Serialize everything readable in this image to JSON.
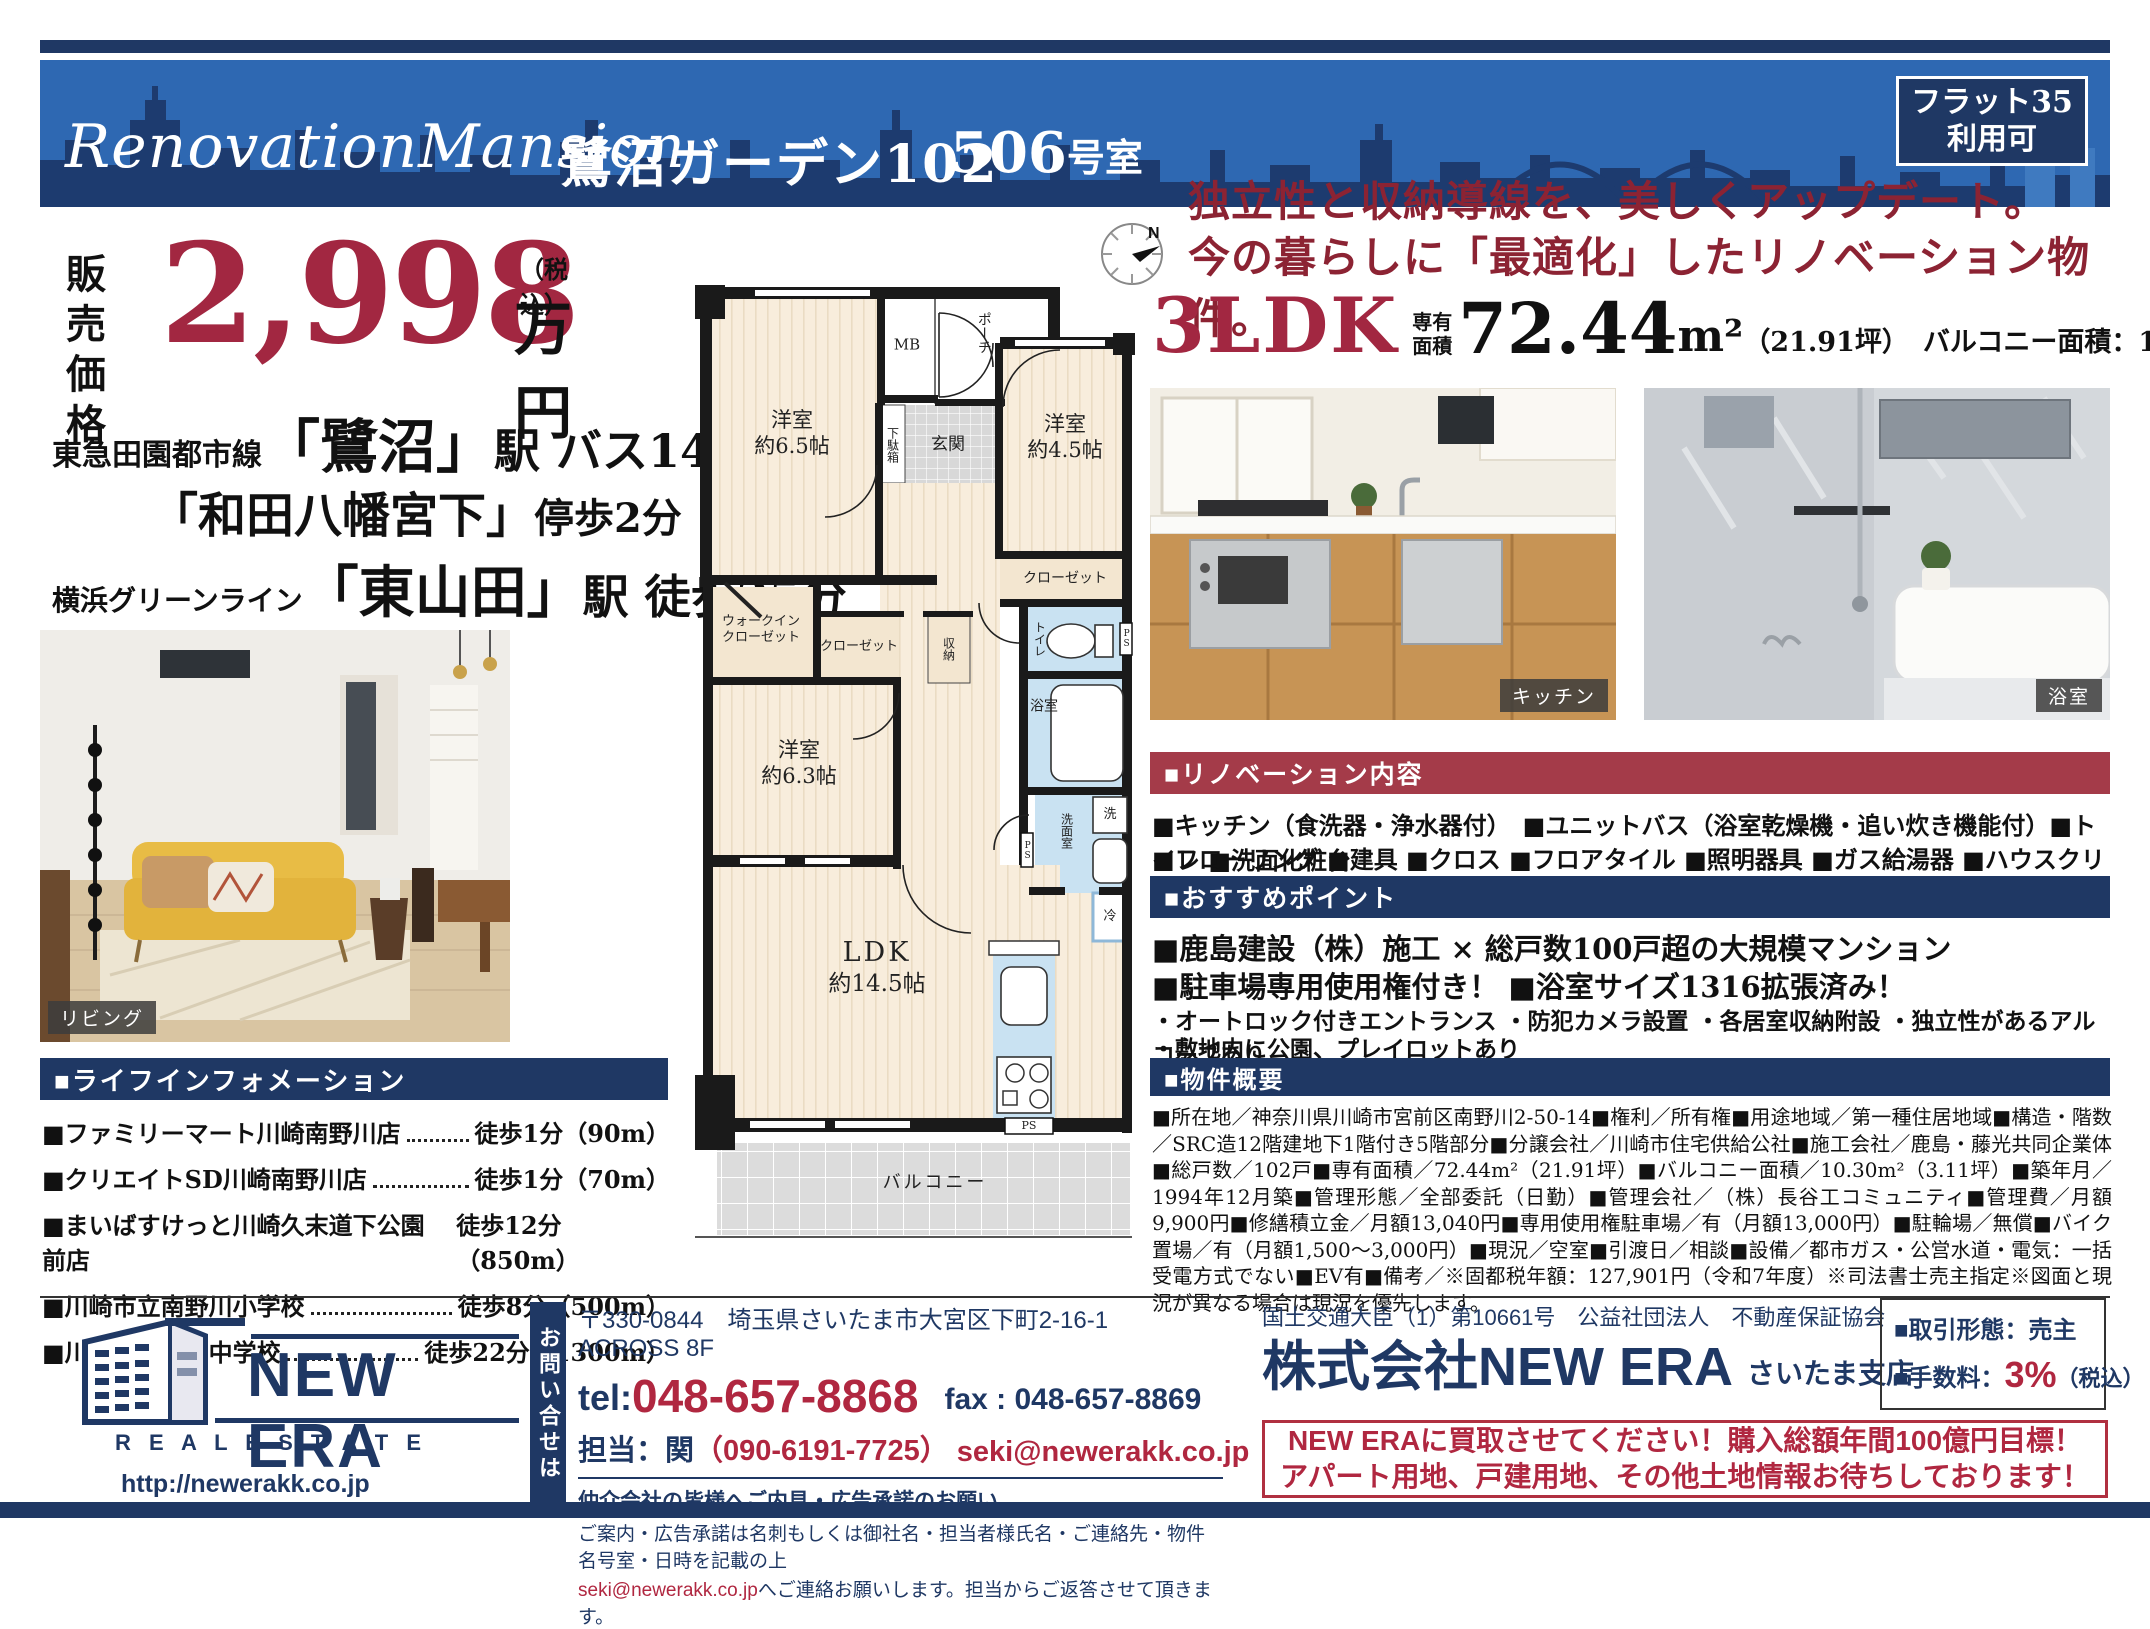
{
  "banner": {
    "title_en": "RenovationMansion",
    "title_name": "鷺沼ガーデン102",
    "room_num": "506",
    "room_suffix": "号室",
    "badge_line1": "フラット35",
    "badge_line2": "利用可"
  },
  "price": {
    "label1": "販売",
    "label2": "価格",
    "amount": "2,998",
    "tax": "（税込）",
    "unit": "万円"
  },
  "access": {
    "line1_prefix": "東急田園都市線",
    "line1_station": "「鷺沼」",
    "line1_rest": "駅 バス14分",
    "line2_station": "「和田八幡宮下」",
    "line2_rest": "停歩2分",
    "line3_prefix": "横浜グリーンライン",
    "line3_station": "「東山田」",
    "line3_rest": "駅 徒歩25分"
  },
  "living": {
    "label": "リビング"
  },
  "life_info": {
    "header": "■ライフインフォメーション",
    "items": [
      {
        "name": "■ファミリーマート川崎南野川店",
        "value": "徒歩1分（90m）"
      },
      {
        "name": "■クリエイトSD川崎南野川店",
        "value": "徒歩1分（70m）"
      },
      {
        "name": "■まいばすけっと川崎久末道下公園前店",
        "value": "徒歩12分（850m）"
      },
      {
        "name": "■川崎市立南野川小学校",
        "value": "徒歩8分（500m）"
      },
      {
        "name": "■川崎市立野川中学校",
        "value": "徒歩22分（1300m）"
      }
    ]
  },
  "plan": {
    "compass": "N",
    "rooms": {
      "mb": "MB",
      "porch": "ポーチ",
      "genkan": "玄関",
      "getabako": "下駄箱",
      "west65_name": "洋室",
      "west65_size": "約6.5帖",
      "west45_name": "洋室",
      "west45_size": "約4.5帖",
      "closet45": "クローゼット",
      "wic1": "ウォークイン",
      "wic2": "クローゼット",
      "closet_small": "クローゼット",
      "shuno": "収納",
      "toilet": "トイレ",
      "ps1": "PS",
      "bath": "浴室",
      "senmen": "洗面室",
      "washer": "洗",
      "ps2": "PS",
      "west63_name": "洋室",
      "west63_size": "約6.3帖",
      "ldk_name": "LDK",
      "ldk_size": "約14.5帖",
      "fridge": "冷",
      "ps3": "PS",
      "balcony": "バルコニー"
    }
  },
  "main": {
    "catch1": "独立性と収納導線を、美しくアップデート。",
    "catch2": "今の暮らしに「最適化」したリノベーション物件。",
    "layout": "3LDK",
    "area_label1": "専有",
    "area_label2": "面積",
    "area_value": "72.44",
    "area_unit": "m²",
    "area_tsubo": "（21.91坪）",
    "balcony_area": "バルコニー面積：10.30m²"
  },
  "photos": {
    "kitchen": "キッチン",
    "bath": "浴室"
  },
  "renovation": {
    "header": "■リノベーション内容",
    "line1": "■キッチン（食洗器・浄水器付）　■ユニットバス（浴室乾燥機・追い炊き機能付）■トイレ ■洗面化粧台",
    "line2": "■フローリング ■建具 ■クロス ■フロアタイル ■照明器具 ■ガス給湯器 ■ハウスクリーニング"
  },
  "points": {
    "header": "■おすすめポイント",
    "bold1": "■鹿島建設（株）施工 × 総戸数100戸超の大規模マンション",
    "bold2": "■駐車場専用使用権付き！ ■浴室サイズ1316拡張済み！",
    "sub1": "・オートロック付きエントランス ・防犯カメラ設置 ・各居室収納附設 ・独立性があるアルコーブあり",
    "sub2": "・敷地内に公園、プレイロットあり"
  },
  "overview": {
    "header": "■物件概要",
    "text": "■所在地／神奈川県川崎市宮前区南野川2-50-14■権利／所有権■用途地域／第一種住居地域■構造・階数／SRC造12階建地下1階付き5階部分■分譲会社／川崎市住宅供給公社■施工会社／鹿島・藤光共同企業体■総戸数／102戸■専有面積／72.44m²（21.91坪）■バルコニー面積／10.30m²（3.11坪）■築年月／1994年12月築■管理形態／全部委託（日勤）■管理会社／（株）長谷工コミュニティ■管理費／月額9,900円■修繕積立金／月額13,040円■専用使用権駐車場／有（月額13,000円）■駐輪場／無償■バイク置場／有（月額1,500～3,000円）■現況／空室■引渡日／相談■設備／都市ガス・公営水道・電気：一括受電方式でない■EV有■備考／※固都税年額：127,901円（令和7年度）※司法書士売主指定※図面と現況が異なる場合は現況を優先します。"
  },
  "footer": {
    "inquiry_vertical": "お問い合せは",
    "logo_name": "NEW ERA",
    "logo_sub": "R E A L   E S T A T E",
    "url": "http://newerakk.co.jp",
    "address": "〒330-0844　埼玉県さいたま市大宮区下町2-16-1　ACROSS 8F",
    "tel_label": "tel:",
    "tel_number": "048-657-8868",
    "fax": "fax : 048-657-8869",
    "staff_label": "担当：関",
    "staff_phone": "（090-6191-7725）",
    "staff_email": "seki@newerakk.co.jp",
    "notice_title": "仲介会社の皆様へご内見・広告承諾のお願い",
    "notice_line1": "ご案内・広告承諾は名刺もしくは御社名・担当者様氏名・ご連絡先・物件名号室・日時を記載の上",
    "notice_line2_email": "seki@newerakk.co.jp",
    "notice_line2_rest": "へご連絡お願いします。担当からご返答させて頂きます。",
    "license": "国土交通大臣（1）第10661号　公益社団法人　不動産保証協会",
    "company": "株式会社NEW ERA",
    "branch": "さいたま支店",
    "deal": "■取引形態：売主",
    "fee_label": "■手数料：",
    "fee_value": "3%",
    "fee_tax": "（税込）",
    "pitch1": "NEW ERAに買取させてください！購入総額年間100億円目標！",
    "pitch2": "アパート用地、戸建用地、その他土地情報お待ちしております！"
  }
}
